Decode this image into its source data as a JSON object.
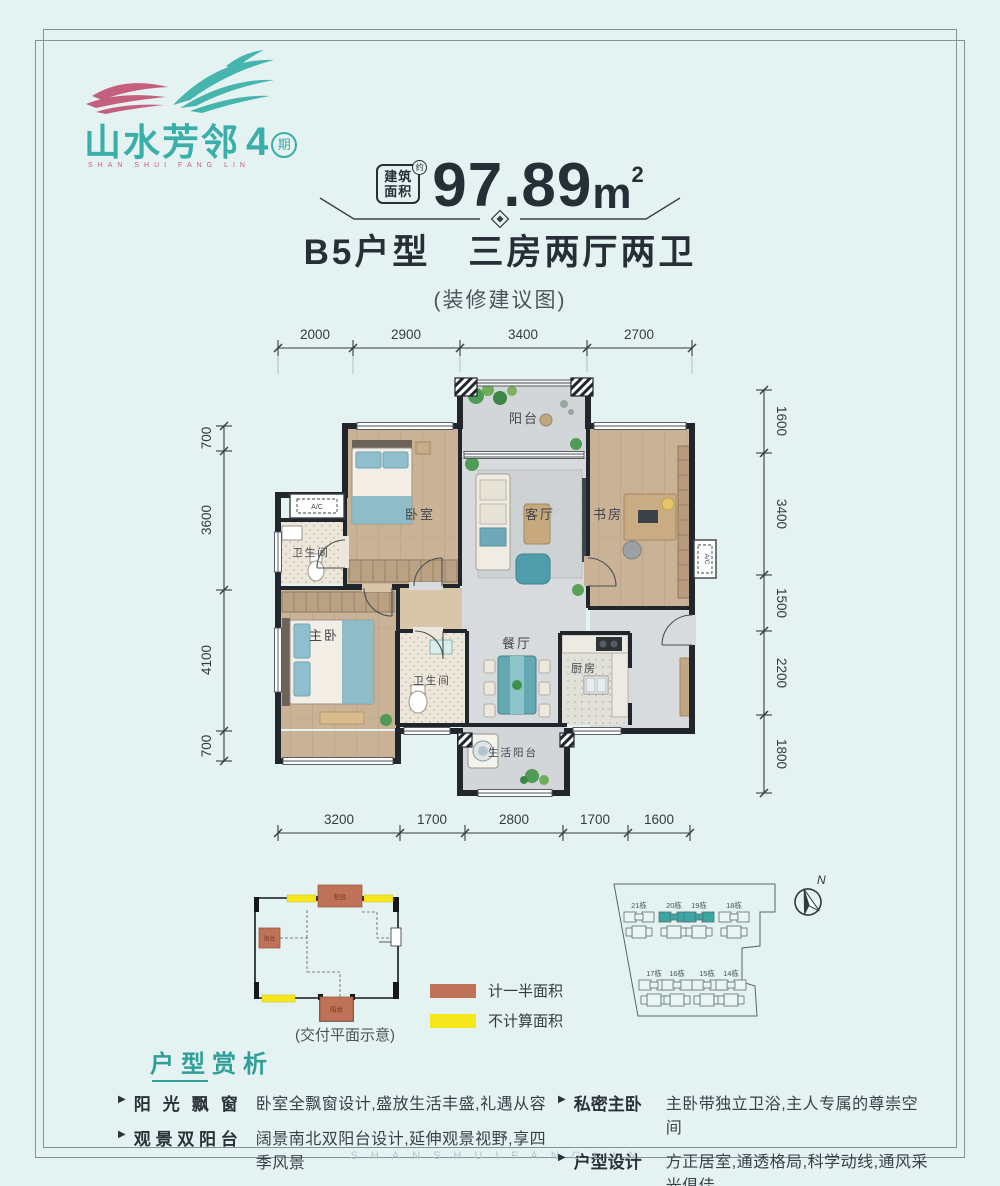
{
  "logo": {
    "name": "山水芳邻",
    "phase": "4",
    "phase_unit": "期",
    "latin": "SHAN SHUI FANG LIN",
    "accent_color": "#3aaea8",
    "pink_color": "#c4607e"
  },
  "header": {
    "area_label_top": "建筑",
    "area_label_bottom": "面积",
    "area_approx": "约",
    "area_value": "97.89",
    "area_unit": "m",
    "area_exp": "2",
    "unit_name": "B5户型　三房两厅两卫",
    "note": "(装修建议图)"
  },
  "floorplan": {
    "dims_top": [
      "2000",
      "2900",
      "3400",
      "2700"
    ],
    "dims_bottom": [
      "3200",
      "1700",
      "2800",
      "1700",
      "1600"
    ],
    "dims_left": [
      "700",
      "3600",
      "4100",
      "700"
    ],
    "dims_right": [
      "1600",
      "3400",
      "1500",
      "2200",
      "1800"
    ],
    "rooms": {
      "balcony": "阳台",
      "bedroom": "卧室",
      "living": "客厅",
      "study": "书房",
      "bath1": "卫生间",
      "master": "主卧",
      "bath2": "卫生间",
      "dining": "餐厅",
      "kitchen": "厨房",
      "service_balcony": "生活阳台"
    },
    "ac": "A/C"
  },
  "delivery": {
    "caption": "(交付平面示意)",
    "balcony": "阳台"
  },
  "legend": {
    "half_label": "计一半面积",
    "half_color": "#bf7257",
    "none_label": "不计算面积",
    "none_color": "#f6e71c"
  },
  "site": {
    "north": "N",
    "highlight_color": "#3aa7a3",
    "buildings": [
      "21栋",
      "20栋",
      "19栋",
      "18栋",
      "17栋",
      "16栋",
      "15栋",
      "14栋"
    ]
  },
  "analysis": {
    "title": "户型赏析",
    "items": [
      {
        "label": "阳光飘窗",
        "text": "卧室全飘窗设计,盛放生活丰盛,礼遇从容"
      },
      {
        "label": "观景双阳台",
        "text": "阔景南北双阳台设计,延伸观景视野,享四季风景"
      },
      {
        "label": "私密主卧",
        "text": "主卧带独立卫浴,主人专属的尊崇空间"
      },
      {
        "label": "户型设计",
        "text": "方正居室,通透格局,科学动线,通风采光俱佳"
      }
    ]
  },
  "watermark": "SHANSHUIFANGLIN"
}
